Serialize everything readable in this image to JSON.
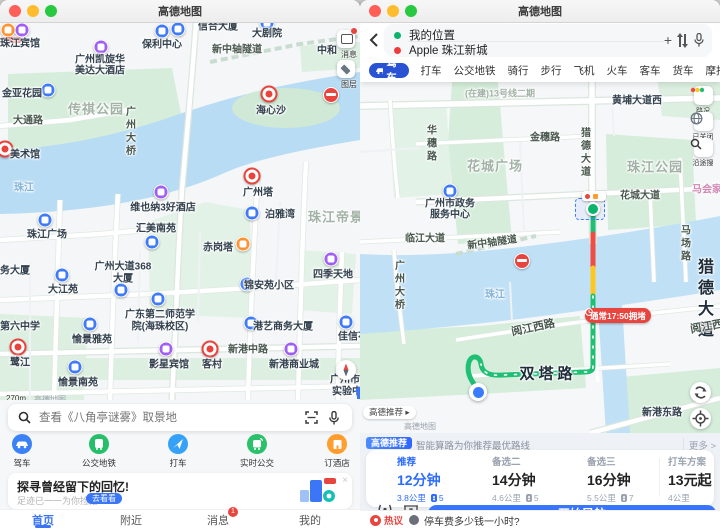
{
  "title": "高德地图",
  "left": {
    "search": {
      "placeholder": "查看《八角亭谜雾》取景地"
    },
    "map_buttons": {
      "messages": "消息",
      "layers": "图层"
    },
    "scale": "270m",
    "watermark": "高德地图",
    "quick": [
      {
        "label": "驾车"
      },
      {
        "label": "公交地铁"
      },
      {
        "label": "打车"
      },
      {
        "label": "实时公交"
      },
      {
        "label": "订酒店"
      }
    ],
    "banner": {
      "title": "探寻曾经留下的回忆!",
      "subtitle": "足迹已一一为你捡拾...",
      "cta": "去看看"
    },
    "tabs": [
      {
        "label": "首页"
      },
      {
        "label": "附近"
      },
      {
        "label": "消息",
        "badge": "1"
      },
      {
        "label": "我的"
      }
    ],
    "labels": [
      "珠江宾馆",
      "广州凯旋华",
      "美达大酒店",
      "保利中心",
      "信合大厦",
      "新中轴隧道",
      "大剧院",
      "中和",
      "金亚花园",
      "传祺公园",
      "大通路",
      "广州大桥",
      "海心沙",
      "美术馆",
      "珠江",
      "珠江广场",
      "维也纳3好酒店",
      "汇美南苑",
      "广州塔",
      "泊雅湾",
      "珠江帝景",
      "赤岗塔",
      "广州大道368",
      "大厦",
      "锦安苑小区",
      "四季天地",
      "务大厦",
      "大江苑",
      "广东第二师范学",
      "院(海珠校区)",
      "愉景雅苑",
      "港艺商务大厦",
      "佳信花",
      "第六中学",
      "影星宾馆",
      "客村",
      "新港中路",
      "新港商业城",
      "鹭江",
      "愉景南苑",
      "广州市景中",
      "实验中学"
    ]
  },
  "right": {
    "route": {
      "from": "我的位置",
      "to": "Apple 珠江新城"
    },
    "modes": [
      {
        "label": "驾车"
      },
      {
        "label": "打车"
      },
      {
        "label": "公交地铁"
      },
      {
        "label": "骑行"
      },
      {
        "label": "步行"
      },
      {
        "label": "飞机"
      },
      {
        "label": "火车"
      },
      {
        "label": "客车"
      },
      {
        "label": "货车"
      },
      {
        "label": "摩托车"
      },
      {
        "label": "新能源"
      }
    ],
    "tools": [
      {
        "label": "路况"
      },
      {
        "label": "已关闭"
      },
      {
        "label": "沿途搜"
      }
    ],
    "traffic_pill": "通常17:50拥堵",
    "rec_pill": "高德推荐",
    "watermark": "高德地图",
    "labels": [
      "(在建)13号线二期",
      "黄埔大道西",
      "华穗路",
      "金穗路",
      "花城广场",
      "猎德大道",
      "珠江公园",
      "花城大道",
      "马场路",
      "马会家",
      "广州市政务",
      "服务中心",
      "临江大道",
      "新中轴隧道",
      "广州大桥",
      "珠江",
      "猎德大道",
      "阅江西路",
      "阅江西路",
      "双塔路",
      "新港东路"
    ],
    "sheet": {
      "badge": "高德推荐",
      "subtitle": "智能算路为你推荐最优路线",
      "more": "更多 >",
      "options": [
        {
          "tag": "推荐",
          "time": "12分钟",
          "dist": "3.8公里",
          "lights": "5"
        },
        {
          "tag": "备选二",
          "time": "14分钟",
          "dist": "4.6公里",
          "lights": "5"
        },
        {
          "tag": "备选三",
          "time": "16分钟",
          "dist": "5.5公里",
          "lights": "7"
        },
        {
          "tag": "打车方案",
          "time": "13元起",
          "dist": "4公里"
        }
      ],
      "explore": "探路",
      "ar": "AR导航",
      "start": "开始导航"
    },
    "qa": {
      "tag": "热议",
      "question": "停车费多少钱一小时?"
    }
  }
}
